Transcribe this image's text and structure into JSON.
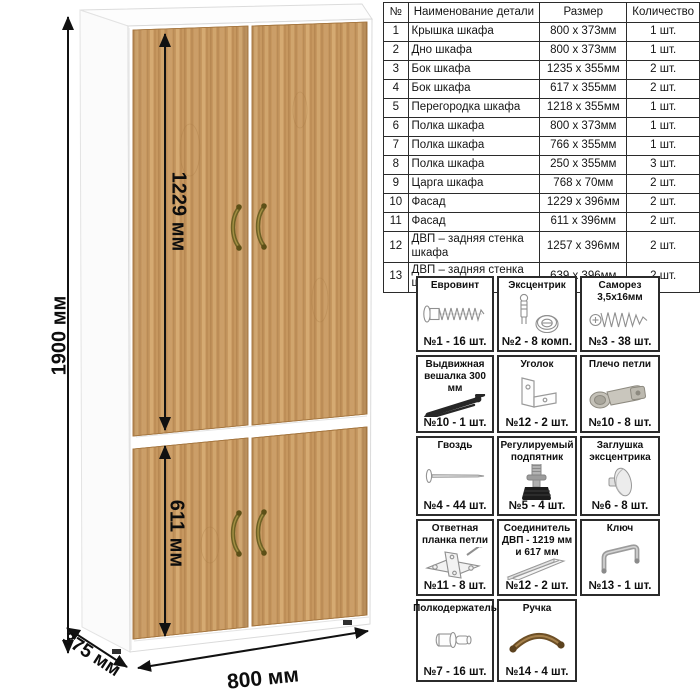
{
  "wardrobe": {
    "dim_height": "1900 мм",
    "dim_upper_door": "1229 мм",
    "dim_lower_door": "611 мм",
    "dim_width": "800 мм",
    "dim_depth": "375 мм",
    "colors": {
      "wood": "#c6975f",
      "wood_dark": "#a87947",
      "wood_light": "#d8ae78",
      "carcass": "#ffffff",
      "handle_bronze": "#6e6125",
      "arrow": "#111111"
    }
  },
  "parts_table": {
    "headers": {
      "num": "№",
      "name": "Наименование детали",
      "size": "Размер",
      "qty": "Количество"
    },
    "rows": [
      {
        "num": "1",
        "name": "Крышка шкафа",
        "size": "800 х 373мм",
        "qty": "1 шт."
      },
      {
        "num": "2",
        "name": "Дно шкафа",
        "size": "800 х 373мм",
        "qty": "1 шт."
      },
      {
        "num": "3",
        "name": "Бок шкафа",
        "size": "1235 х 355мм",
        "qty": "2 шт."
      },
      {
        "num": "4",
        "name": "Бок шкафа",
        "size": "617 х 355мм",
        "qty": "2 шт."
      },
      {
        "num": "5",
        "name": "Перегородка шкафа",
        "size": "1218 х 355мм",
        "qty": "1 шт."
      },
      {
        "num": "6",
        "name": "Полка шкафа",
        "size": "800 х 373мм",
        "qty": "1 шт."
      },
      {
        "num": "7",
        "name": "Полка шкафа",
        "size": "766 х 355мм",
        "qty": "1 шт."
      },
      {
        "num": "8",
        "name": "Полка шкафа",
        "size": "250 х 355мм",
        "qty": "3 шт."
      },
      {
        "num": "9",
        "name": "Царга шкафа",
        "size": "768 х 70мм",
        "qty": "2 шт."
      },
      {
        "num": "10",
        "name": "Фасад",
        "size": "1229 х 396мм",
        "qty": "2 шт."
      },
      {
        "num": "11",
        "name": "Фасад",
        "size": "611 х 396мм",
        "qty": "2 шт."
      },
      {
        "num": "12",
        "name": "ДВП – задняя стенка шкафа",
        "size": "1257 х 396мм",
        "qty": "2 шт."
      },
      {
        "num": "13",
        "name": "ДВП – задняя стенка шкафа",
        "size": "639 х 396мм",
        "qty": "2 шт."
      }
    ]
  },
  "hardware": {
    "items": [
      {
        "title": "Евровинт",
        "count": "№1 - 16 шт.",
        "icon": "euro-screw-icon"
      },
      {
        "title": "Эксцентрик",
        "count": "№2 - 8 комп.",
        "icon": "eccentric-cam-icon"
      },
      {
        "title": "Саморез 3,5х16мм",
        "count": "№3 - 38 шт.",
        "icon": "self-tapping-screw-icon"
      },
      {
        "title": "Выдвижная вешалка 300 мм",
        "count": "№10 - 1 шт.",
        "icon": "pullout-hanger-icon"
      },
      {
        "title": "Уголок",
        "count": "№12 - 2 шт.",
        "icon": "corner-bracket-icon"
      },
      {
        "title": "Плечо петли",
        "count": "№10 - 8 шт.",
        "icon": "hinge-arm-icon"
      },
      {
        "title": "Гвоздь",
        "count": "№4 - 44 шт.",
        "icon": "nail-icon"
      },
      {
        "title": "Регулируемый подпятник",
        "count": "№5 - 4 шт.",
        "icon": "adjustable-foot-icon"
      },
      {
        "title": "Заглушка эксцентрика",
        "count": "№6 - 8 шт.",
        "icon": "cam-cover-icon"
      },
      {
        "title": "Ответная планка петли",
        "count": "№11 - 8 шт.",
        "icon": "hinge-plate-icon"
      },
      {
        "title": "Соединитель ДВП - 1219 мм и 617 мм",
        "count": "№12 - 2 шт.",
        "icon": "hdf-connector-icon"
      },
      {
        "title": "Ключ",
        "count": "№13 - 1 шт.",
        "icon": "key-icon"
      },
      {
        "title": "Полкодержатель",
        "count": "№7 - 16 шт.",
        "icon": "shelf-pin-icon"
      },
      {
        "title": "Ручка",
        "count": "№14 - 4 шт.",
        "icon": "handle-icon"
      }
    ]
  }
}
